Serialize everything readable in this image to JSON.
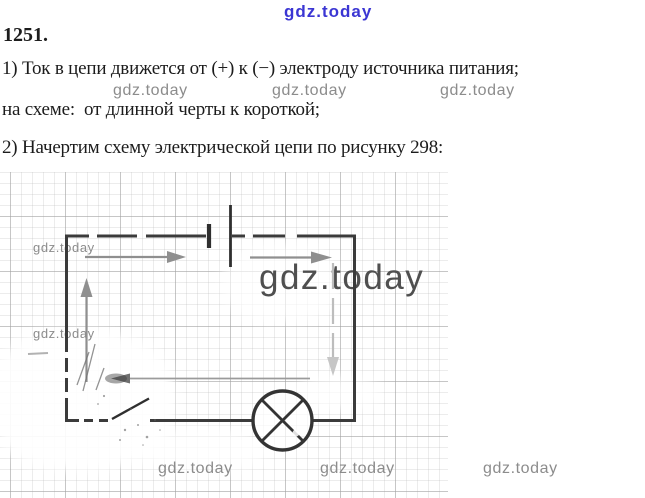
{
  "solution": {
    "problem_number": "1251.",
    "lines": [
      "1) Ток в цепи движется от (+) к (−) электроду источника питания;",
      "на схеме:  от длинной черты к короткой;",
      "2) Начертим схему электрической цепи по рисунку 298:"
    ]
  },
  "watermarks": {
    "text": "gdz.today",
    "top_color": "#3b36d3",
    "gray_color": "#8c8c8c",
    "big_color": "#4f4f4f"
  },
  "diagram": {
    "kind": "electric-circuit-schematic",
    "figure_reference": "298",
    "drawn_on": "graph-paper",
    "components": [
      "battery-long-and-short-electrode",
      "open-switch",
      "lamp-circle-with-cross",
      "current-direction-arrows"
    ],
    "current_path": "up-left-side, right-along-top, down-right-side, left-along-bottom",
    "wire_color": "#3b3b3b",
    "arrow_color": "#8f8f8f",
    "grid_major_color": "#c4c4c4",
    "grid_minor_color": "#e7e7e7"
  }
}
